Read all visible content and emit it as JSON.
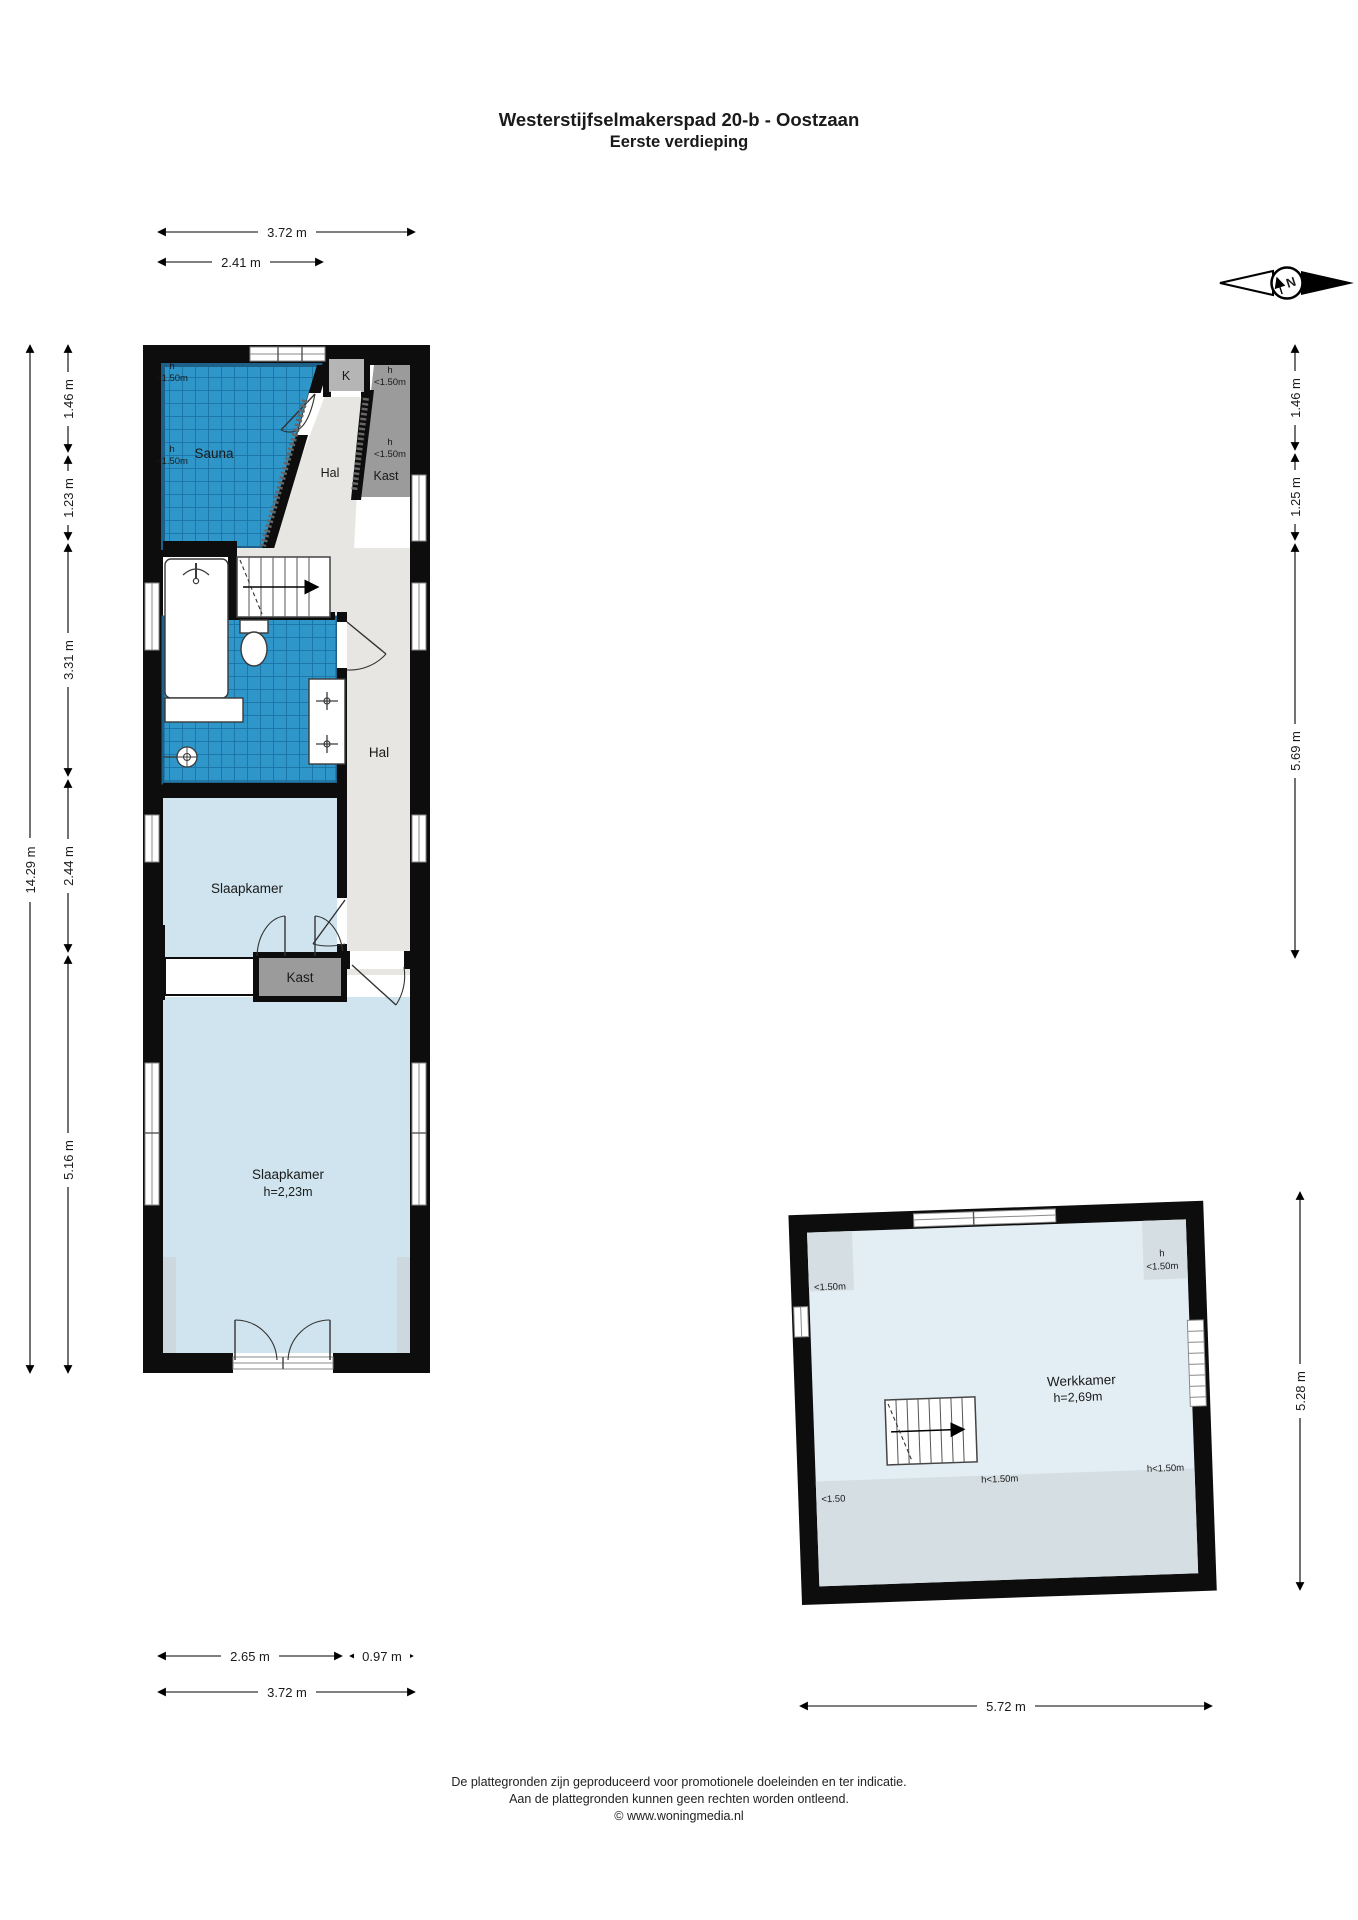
{
  "title": {
    "line1": "Westerstijfselmakerspad 20-b - Oostzaan",
    "line2": "Eerste verdieping"
  },
  "compass": {
    "n": "N"
  },
  "floor1": {
    "rooms": {
      "sauna": "Sauna",
      "k": "K",
      "hal_upper": "Hal",
      "kast_upper": "Kast",
      "hal": "Hal",
      "slaapkamer1": "Slaapkamer",
      "kast": "Kast",
      "slaapkamer2": "Slaapkamer",
      "slaapkamer2_height": "h=2,23m"
    },
    "h_labels": {
      "h": "h",
      "lt150": "<1.50m"
    },
    "dims": {
      "top_total": "3.72 m",
      "top_part": "2.41 m",
      "left_total": "14.29 m",
      "l1": "1.46 m",
      "l2": "1.23 m",
      "l3": "3.31 m",
      "l4": "2.44 m",
      "l5": "5.16 m",
      "r1": "1.46 m",
      "r2": "1.25 m",
      "r3": "5.69 m",
      "b1": "2.65 m",
      "b2": "0.97 m",
      "b_total": "3.72 m"
    }
  },
  "annex": {
    "rooms": {
      "werkkamer": "Werkkamer",
      "werkkamer_height": "h=2,69m"
    },
    "h_labels": {
      "h": "h",
      "lt150": "<1.50m",
      "lt150_short": "<1.50",
      "h_lt150": "h<1.50m"
    },
    "dims": {
      "right_total": "5.28 m",
      "bottom_total": "5.72 m"
    }
  },
  "footer": {
    "line1": "De plattegronden zijn geproduceerd voor promotionele doeleinden en ter indicatie.",
    "line2": "Aan de plattegronden kunnen geen rechten worden ontleend.",
    "line3": "© www.woningmedia.nl"
  },
  "colors": {
    "wall": "#0d0d0d",
    "tile_blue": "#2e96c8",
    "tile_grid": "#176f9f",
    "tile_border": "#1d608a",
    "room_light_blue": "#cfe4ee",
    "annex_light_blue": "#e3eef4",
    "hal_gray": "#e7e6e2",
    "closet_gray": "#9b9b9b",
    "k_gray": "#b5b5b5",
    "low_height_gray": "#d5dfe3"
  }
}
